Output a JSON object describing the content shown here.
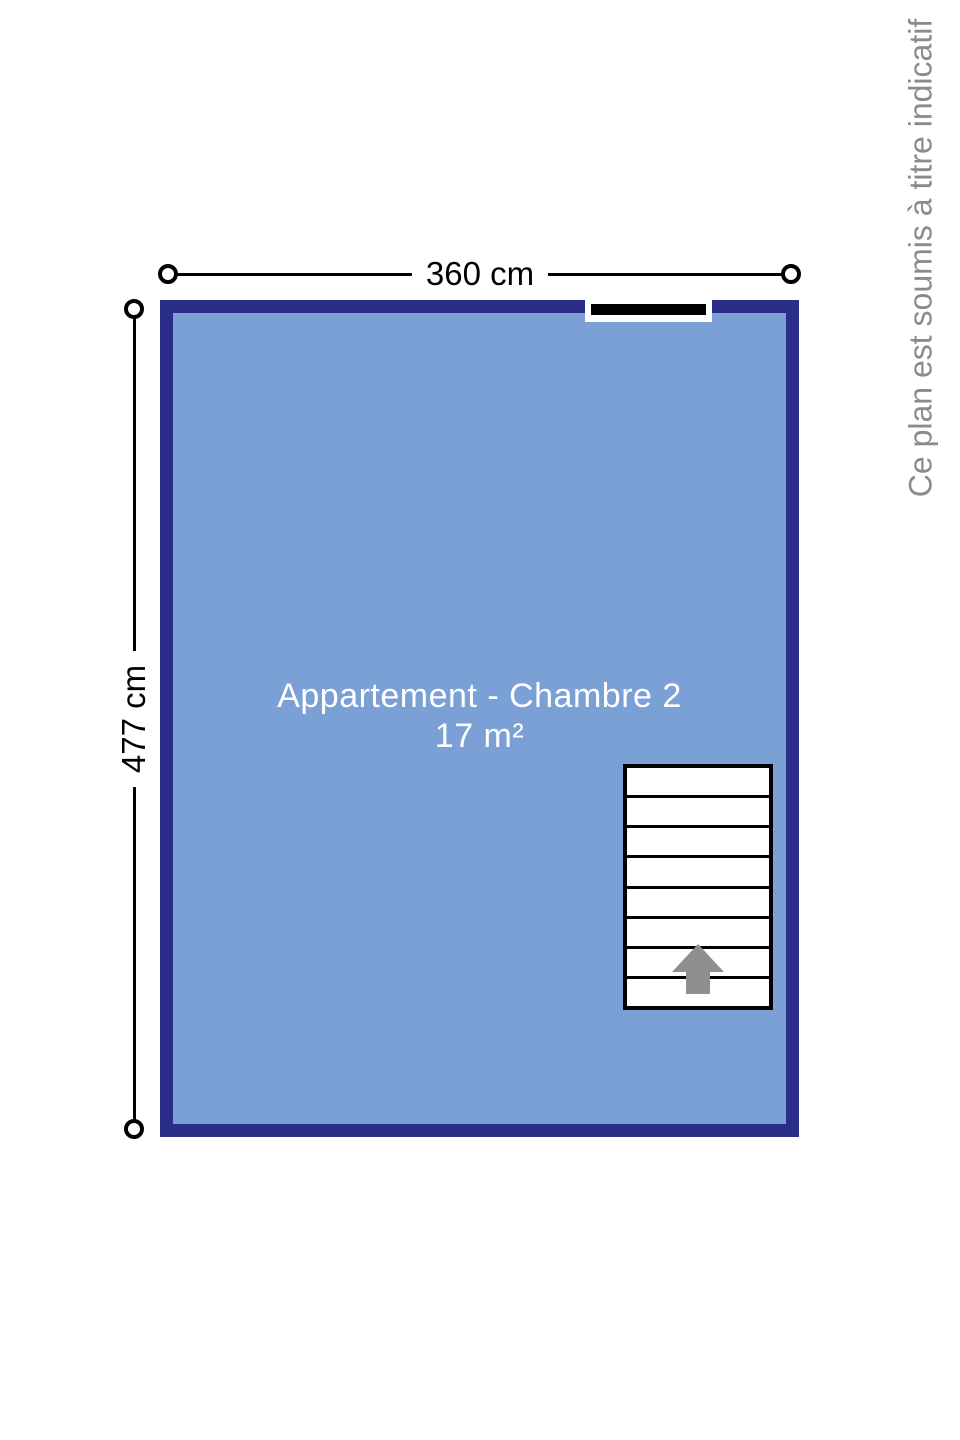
{
  "plan": {
    "room_name": "Appartement - Chambre 2",
    "room_area": "17 m²",
    "dimensions": {
      "width_label": "360 cm",
      "height_label": "477 cm"
    },
    "disclaimer": "Ce plan est soumis à titre indicatif",
    "stairs": {
      "steps": 8,
      "direction_icon": "up-arrow-icon"
    },
    "icons": {
      "dimension_endpoint": "circle-endpoint-icon",
      "stair_direction": "up-arrow-icon"
    },
    "colors": {
      "wall": "#2b2e86",
      "room_fill": "#7ba0d6",
      "dimension_line": "#000000",
      "window_bar": "#000000",
      "stair_arrow": "#8f8f8f",
      "disclaimer_text": "#8b8b8b",
      "room_text": "#ffffff"
    }
  }
}
